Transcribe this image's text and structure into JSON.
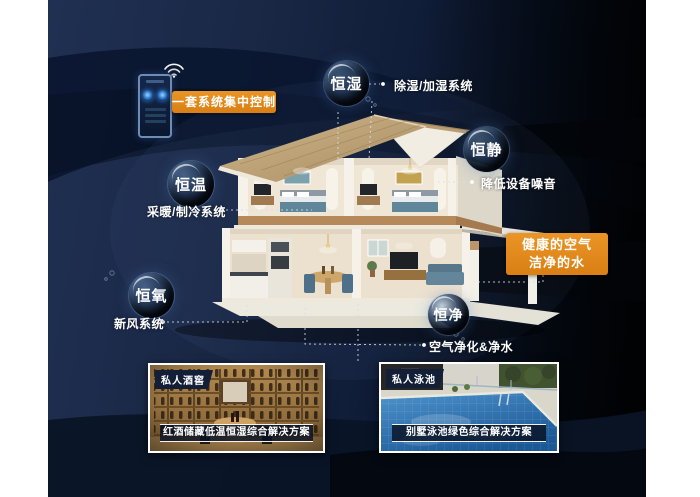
{
  "colors": {
    "accent_orange": "#e0891c",
    "panel_navy": "#1d2c4e",
    "panel_dark": "#04070d",
    "text_white": "#ffffff"
  },
  "control": {
    "label": "一套系统集中控制"
  },
  "bubbles": [
    {
      "text": "恒湿",
      "label": "除湿/加湿系统"
    },
    {
      "text": "恒静",
      "label": "降低设备噪音"
    },
    {
      "text": "恒温",
      "label": "采暖/制冷系统"
    },
    {
      "text": "恒氧",
      "label": "新风系统"
    },
    {
      "text": "恒净",
      "label": "空气净化&净水"
    }
  ],
  "highlight": {
    "line1": "健康的空气",
    "line2": "洁净的水"
  },
  "cards": {
    "wine": {
      "tag": "私人酒窖",
      "caption": "红酒储藏低温恒湿综合解决方案"
    },
    "pool": {
      "tag": "私人泳池",
      "caption": "别墅泳池绿色综合解决方案"
    }
  }
}
